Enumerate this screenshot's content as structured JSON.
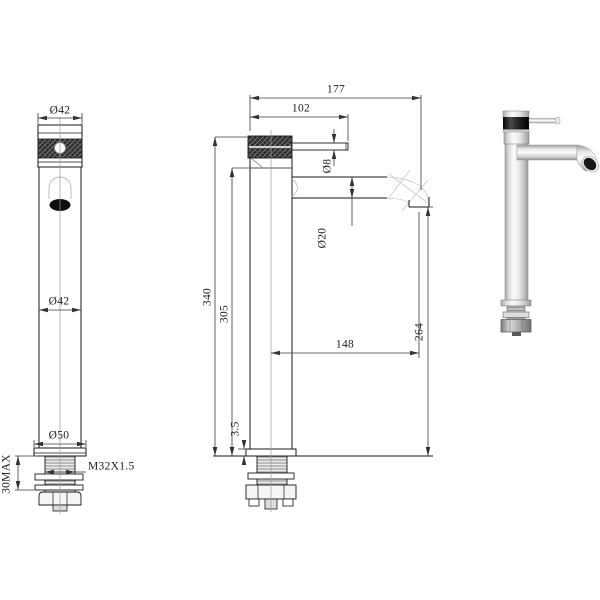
{
  "drawing": {
    "ink_color": "#1a1a1a",
    "dim_color": "#3a3a3a",
    "centerline_color": "#9a9a9a",
    "front_view": {
      "top_diameter": "Ø42",
      "body_diameter": "Ø42",
      "base_diameter": "Ø50",
      "thread_spec": "M32X1.5",
      "max_mounting_thickness": "30MAX"
    },
    "side_view": {
      "overall_reach": "177",
      "handle_reach": "102",
      "lever_diameter": "Ø8",
      "spout_diameter": "Ø20",
      "overall_height": "340",
      "body_height": "305",
      "outlet_height": "264",
      "spout_reach": "148",
      "base_plate_thickness": "3.5"
    }
  }
}
